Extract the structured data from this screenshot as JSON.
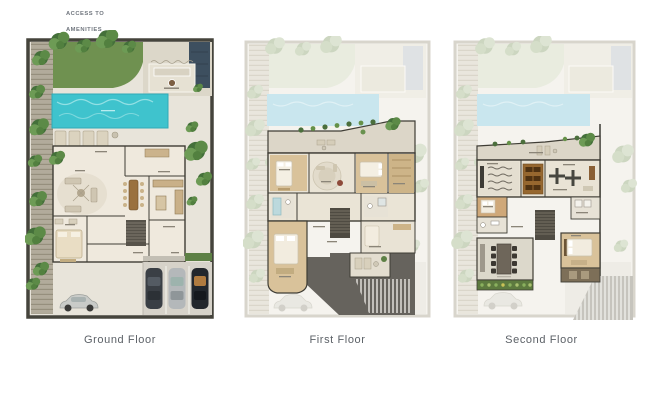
{
  "header": {
    "access_note": {
      "line1": "ACCESS TO",
      "line2": "AMENITIES"
    }
  },
  "floors": [
    {
      "id": "ground-floor",
      "caption": "Ground Floor"
    },
    {
      "id": "first-floor",
      "caption": "First Floor"
    },
    {
      "id": "second-floor",
      "caption": "Second Floor"
    }
  ],
  "colors": {
    "pool": "#3fc3cd",
    "pool_faded": "#c9e6ee",
    "lawn": "#6f9150",
    "tree": "#44703a",
    "stone": "#e8e4da",
    "patio": "#dcd7c9",
    "deck": "#b2ab9b",
    "wall": "#3f3d35",
    "wood_floor": "#d9c29a",
    "roof_dark": "#66635d",
    "water_feature": "#3d4f5f",
    "planter_green": "#5d7a3f",
    "driveway": "#d6d2c9",
    "caption_text": "#5c6167",
    "note_text": "#70767e"
  }
}
